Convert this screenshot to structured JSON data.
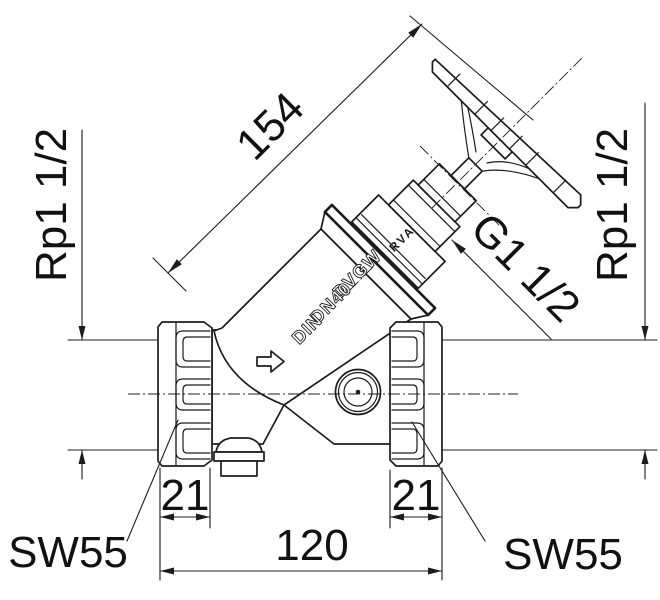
{
  "drawing": {
    "type": "valve-technical-drawing",
    "dimensions": {
      "diagonal_height": "154",
      "port_left_thread": "Rp1 1/2",
      "port_right_thread": "Rp1 1/2",
      "bonnet_thread": "G1 1/2",
      "hex_length_left": "21",
      "hex_length_right": "21",
      "face_to_face": "120",
      "wrench_size_left": "SW55",
      "wrench_size_right": "SW55"
    },
    "cast_marks": {
      "approval": "DVGW",
      "nominal_size": "DN40",
      "standard": "DIN",
      "bonnet": "RVA"
    },
    "colors": {
      "line": "#1c1c1c",
      "background": "#ffffff"
    }
  }
}
